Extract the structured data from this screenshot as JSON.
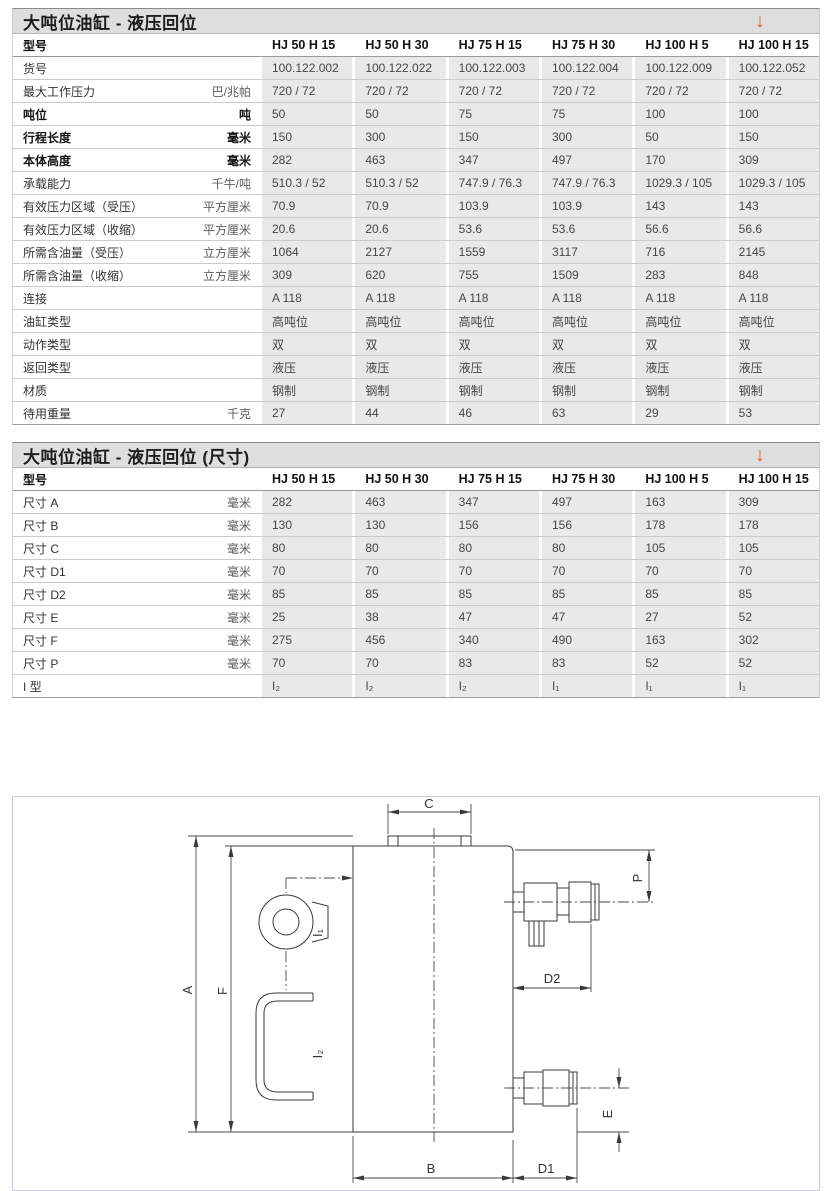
{
  "table1": {
    "title": "大吨位油缸 - 液压回位",
    "download_arrow": "↓",
    "model_label": "型号",
    "columns": [
      "HJ 50 H 15",
      "HJ 50 H 30",
      "HJ 75 H 15",
      "HJ 75 H 30",
      "HJ 100 H 5",
      "HJ 100 H 15"
    ],
    "rows": [
      {
        "label": "货号",
        "unit": "",
        "values": [
          "100.122.002",
          "100.122.022",
          "100.122.003",
          "100.122.004",
          "100.122.009",
          "100.122.052"
        ]
      },
      {
        "label": "最大工作压力",
        "unit": "巴/兆帕",
        "values": [
          "720 / 72",
          "720 / 72",
          "720 / 72",
          "720 / 72",
          "720 / 72",
          "720 / 72"
        ]
      },
      {
        "label": "吨位",
        "unit": "吨",
        "bold": true,
        "values": [
          "50",
          "50",
          "75",
          "75",
          "100",
          "100"
        ]
      },
      {
        "label": "行程长度",
        "unit": "毫米",
        "bold": true,
        "values": [
          "150",
          "300",
          "150",
          "300",
          "50",
          "150"
        ]
      },
      {
        "label": "本体高度",
        "unit": "毫米",
        "bold": true,
        "values": [
          "282",
          "463",
          "347",
          "497",
          "170",
          "309"
        ]
      },
      {
        "label": "承载能力",
        "unit": "千牛/吨",
        "values": [
          "510.3 / 52",
          "510.3 / 52",
          "747.9 / 76.3",
          "747.9 / 76.3",
          "1029.3 / 105",
          "1029.3 / 105"
        ]
      },
      {
        "label": "有效压力区域（受压）",
        "unit": "平方厘米",
        "values": [
          "70.9",
          "70.9",
          "103.9",
          "103.9",
          "143",
          "143"
        ]
      },
      {
        "label": "有效压力区域（收缩）",
        "unit": "平方厘米",
        "values": [
          "20.6",
          "20.6",
          "53.6",
          "53.6",
          "56.6",
          "56.6"
        ]
      },
      {
        "label": "所需含油量（受压）",
        "unit": "立方厘米",
        "values": [
          "1064",
          "2127",
          "1559",
          "3117",
          "716",
          "2145"
        ]
      },
      {
        "label": "所需含油量（收缩）",
        "unit": "立方厘米",
        "values": [
          "309",
          "620",
          "755",
          "1509",
          "283",
          "848"
        ]
      },
      {
        "label": "连接",
        "unit": "",
        "values": [
          "A 118",
          "A 118",
          "A 118",
          "A 118",
          "A 118",
          "A 118"
        ]
      },
      {
        "label": "油缸类型",
        "unit": "",
        "values": [
          "高吨位",
          "高吨位",
          "高吨位",
          "高吨位",
          "高吨位",
          "高吨位"
        ]
      },
      {
        "label": "动作类型",
        "unit": "",
        "values": [
          "双",
          "双",
          "双",
          "双",
          "双",
          "双"
        ]
      },
      {
        "label": "返回类型",
        "unit": "",
        "values": [
          "液压",
          "液压",
          "液压",
          "液压",
          "液压",
          "液压"
        ]
      },
      {
        "label": "材质",
        "unit": "",
        "values": [
          "钢制",
          "钢制",
          "钢制",
          "钢制",
          "钢制",
          "钢制"
        ]
      },
      {
        "label": "待用重量",
        "unit": "千克",
        "values": [
          "27",
          "44",
          "46",
          "63",
          "29",
          "53"
        ]
      }
    ]
  },
  "table2": {
    "title": "大吨位油缸 - 液压回位 (尺寸)",
    "download_arrow": "↓",
    "model_label": "型号",
    "columns": [
      "HJ 50 H 15",
      "HJ 50 H 30",
      "HJ 75 H 15",
      "HJ 75 H 30",
      "HJ 100 H 5",
      "HJ 100 H 15"
    ],
    "rows": [
      {
        "label": "尺寸 A",
        "unit": "毫米",
        "values": [
          "282",
          "463",
          "347",
          "497",
          "163",
          "309"
        ]
      },
      {
        "label": "尺寸 B",
        "unit": "毫米",
        "values": [
          "130",
          "130",
          "156",
          "156",
          "178",
          "178"
        ]
      },
      {
        "label": "尺寸 C",
        "unit": "毫米",
        "values": [
          "80",
          "80",
          "80",
          "80",
          "105",
          "105"
        ]
      },
      {
        "label": "尺寸 D1",
        "unit": "毫米",
        "values": [
          "70",
          "70",
          "70",
          "70",
          "70",
          "70"
        ]
      },
      {
        "label": "尺寸 D2",
        "unit": "毫米",
        "values": [
          "85",
          "85",
          "85",
          "85",
          "85",
          "85"
        ]
      },
      {
        "label": "尺寸 E",
        "unit": "毫米",
        "values": [
          "25",
          "38",
          "47",
          "47",
          "27",
          "52"
        ]
      },
      {
        "label": "尺寸 F",
        "unit": "毫米",
        "values": [
          "275",
          "456",
          "340",
          "490",
          "163",
          "302"
        ]
      },
      {
        "label": "尺寸 P",
        "unit": "毫米",
        "values": [
          "70",
          "70",
          "83",
          "83",
          "52",
          "52"
        ]
      },
      {
        "label": "I 型",
        "unit": "",
        "values": [
          "I₂",
          "I₂",
          "I₂",
          "I₁",
          "I₁",
          "I₁"
        ]
      }
    ]
  },
  "diagram": {
    "labels": {
      "a": "A",
      "f": "F",
      "c": "C",
      "p": "P",
      "d2": "D2",
      "e": "E",
      "b": "B",
      "d1": "D1",
      "i1": "I₁",
      "i2": "I₂"
    }
  },
  "colors": {
    "accent_orange": "#e8641e",
    "title_bar_bg": "#dedede",
    "cell_bg": "#e9e9e9"
  }
}
